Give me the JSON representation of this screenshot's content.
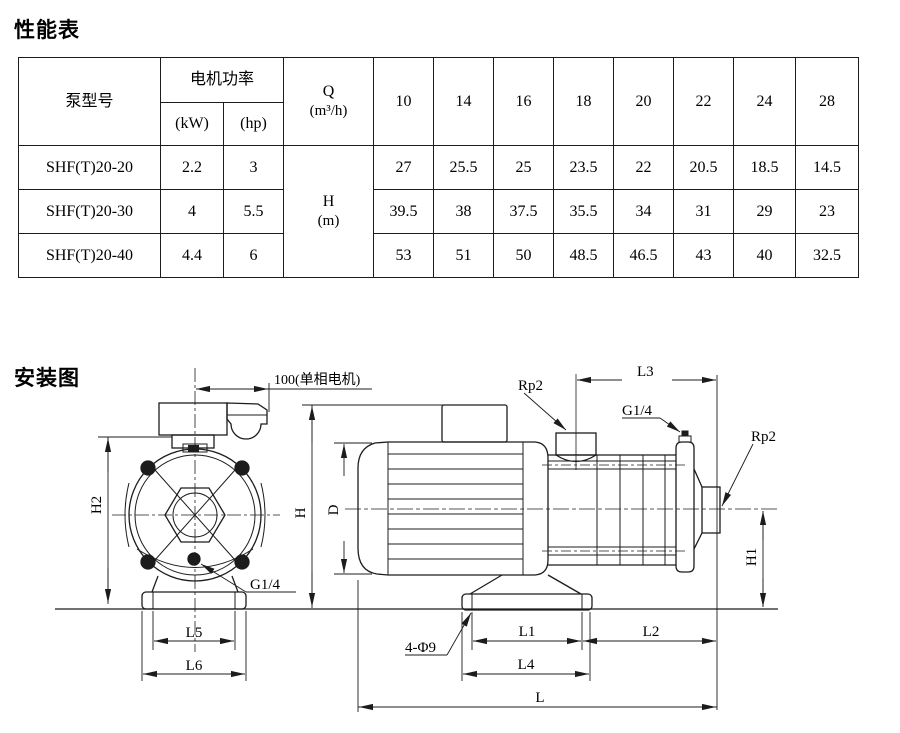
{
  "performance": {
    "section_title": "性能表",
    "columns": {
      "pump_model": "泵型号",
      "motor_power": "电机功率",
      "kw": "(kW)",
      "hp": "(hp)",
      "q": "Q",
      "q_unit": "(m³/h)",
      "h": "H",
      "h_unit": "(m)"
    },
    "flow_values": [
      "10",
      "14",
      "16",
      "18",
      "20",
      "22",
      "24",
      "28"
    ],
    "rows": [
      {
        "model": "SHF(T)20-20",
        "kw": "2.2",
        "hp": "3",
        "heads": [
          "27",
          "25.5",
          "25",
          "23.5",
          "22",
          "20.5",
          "18.5",
          "14.5"
        ]
      },
      {
        "model": "SHF(T)20-30",
        "kw": "4",
        "hp": "5.5",
        "heads": [
          "39.5",
          "38",
          "37.5",
          "35.5",
          "34",
          "31",
          "29",
          "23"
        ]
      },
      {
        "model": "SHF(T)20-40",
        "kw": "4.4",
        "hp": "6",
        "heads": [
          "53",
          "51",
          "50",
          "48.5",
          "46.5",
          "43",
          "40",
          "32.5"
        ]
      }
    ]
  },
  "installation": {
    "section_title": "安装图",
    "labels": {
      "motor_offset": "100(单相电机)",
      "rp2_top": "Rp2",
      "l3": "L3",
      "g14_vent": "G1/4",
      "rp2_right": "Rp2",
      "h2": "H2",
      "h": "H",
      "d": "D",
      "h1": "H1",
      "g14_drain": "G1/4",
      "l5": "L5",
      "l6": "L6",
      "bolt_holes": "4-Φ9",
      "l1": "L1",
      "l2": "L2",
      "l4": "L4",
      "l": "L"
    }
  }
}
